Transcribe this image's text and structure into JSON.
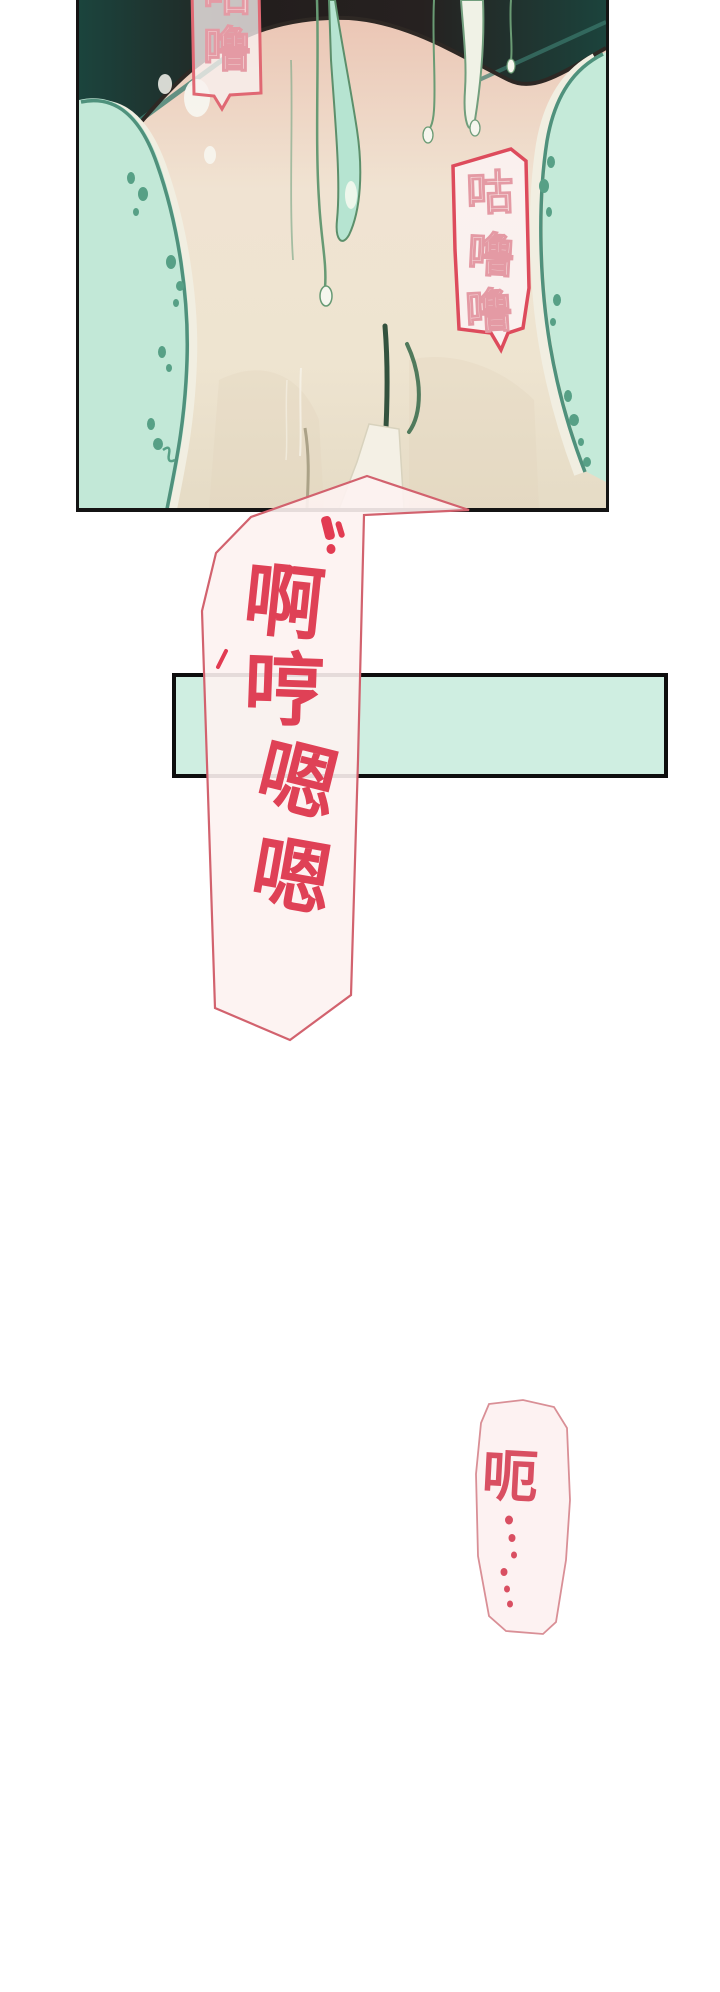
{
  "page": {
    "type": "webtoon-comic-page",
    "background_color": "#ffffff"
  },
  "panel": {
    "description": "illustration panel",
    "border_color": "#141414",
    "background_mint": "#c9ebdb",
    "dark_wall": "#241f1e",
    "dark_wall_teal": "#1b443d",
    "skin_tone": "#eccaba",
    "sheet_outline": "#4f917c"
  },
  "bubbles": {
    "top_left": {
      "text": "咕噜",
      "chars": [
        "咕",
        "噜"
      ],
      "style": "outlined",
      "border_color": "#e06873"
    },
    "right": {
      "text": "咕噜噜",
      "chars": [
        "咕",
        "噜",
        "噜"
      ],
      "style": "outlined",
      "border_color": "#dd4b5c"
    },
    "main": {
      "text": "啊哼嗯嗯",
      "chars": [
        "啊",
        "哼",
        "嗯",
        "嗯"
      ],
      "style": "solid-red",
      "text_color": "#df4156",
      "border_color": "#d2626e"
    },
    "bottom": {
      "text": "呃⋯⋯",
      "chars": [
        "呃"
      ],
      "ellipsis_dot_count": 6,
      "text_color": "#d94f62",
      "border_color": "#d98f96"
    }
  },
  "banner": {
    "fill_color": "#cfeee1",
    "border_color": "#0d0d0d"
  }
}
